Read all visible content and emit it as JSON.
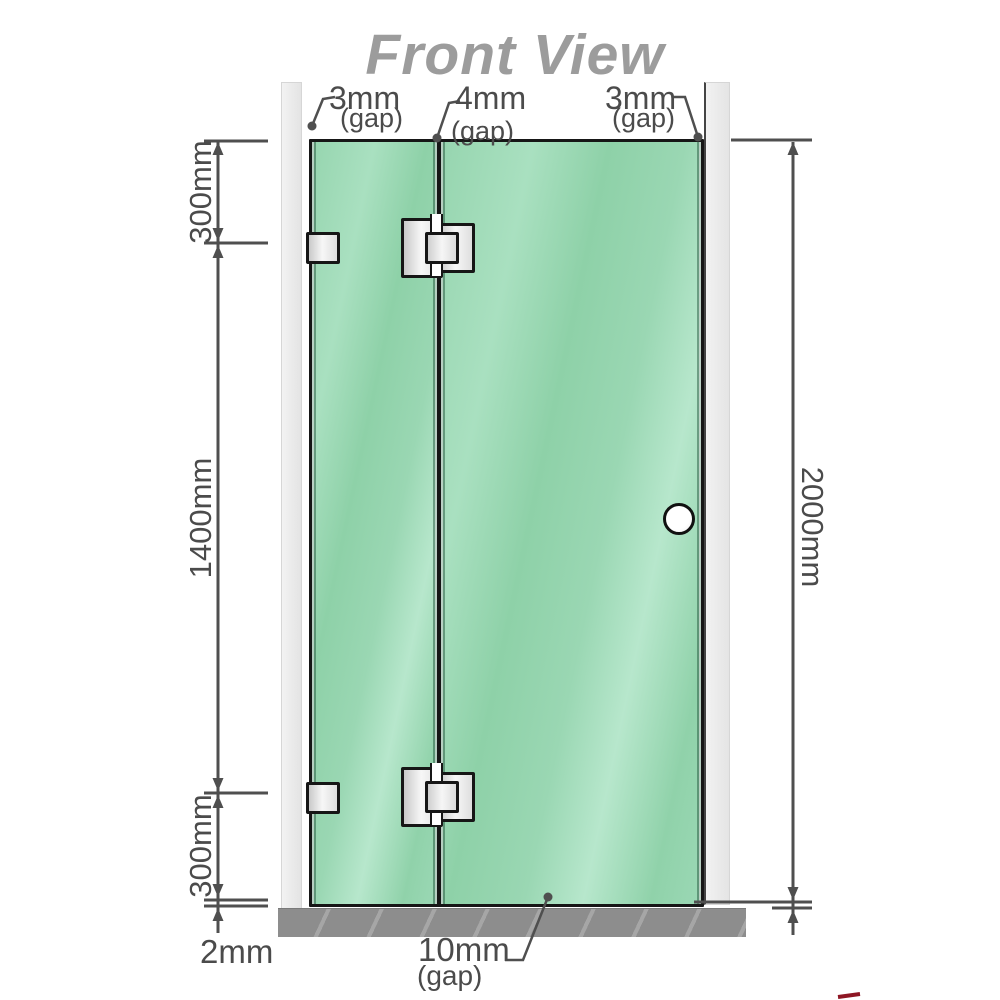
{
  "title": "Front View",
  "gaps": {
    "left": {
      "value": "3mm",
      "label": "(gap)"
    },
    "middle": {
      "value": "4mm",
      "label": "(gap)"
    },
    "right": {
      "value": "3mm",
      "label": "(gap)"
    },
    "bottom": {
      "value": "10mm",
      "label": "(gap)"
    }
  },
  "dimensions": {
    "top_segment": "300mm",
    "middle_segment": "1400mm",
    "bottom_segment": "300mm",
    "total_height": "2000mm",
    "floor_clearance": "2mm"
  },
  "colors": {
    "glass_green": "#8fd3ab",
    "glass_highlight": "#b7e7cc",
    "wall_gray": "#e9e9e9",
    "base_gray": "#8d8d8d",
    "outline_black": "#161616",
    "dimension_gray": "#4f4f4f",
    "title_gray": "#9c9c9c",
    "hardware_silver": "#e0e0e0",
    "accent_red": "#8e1624"
  },
  "components": {
    "left_wall": "wall",
    "right_wall": "wall",
    "fixed_panel": "glass panel",
    "door_panel": "glass door",
    "hinge": "glass-to-glass hinge",
    "bracket": "wall bracket",
    "handle": "door knob",
    "base": "floor / shower base"
  }
}
